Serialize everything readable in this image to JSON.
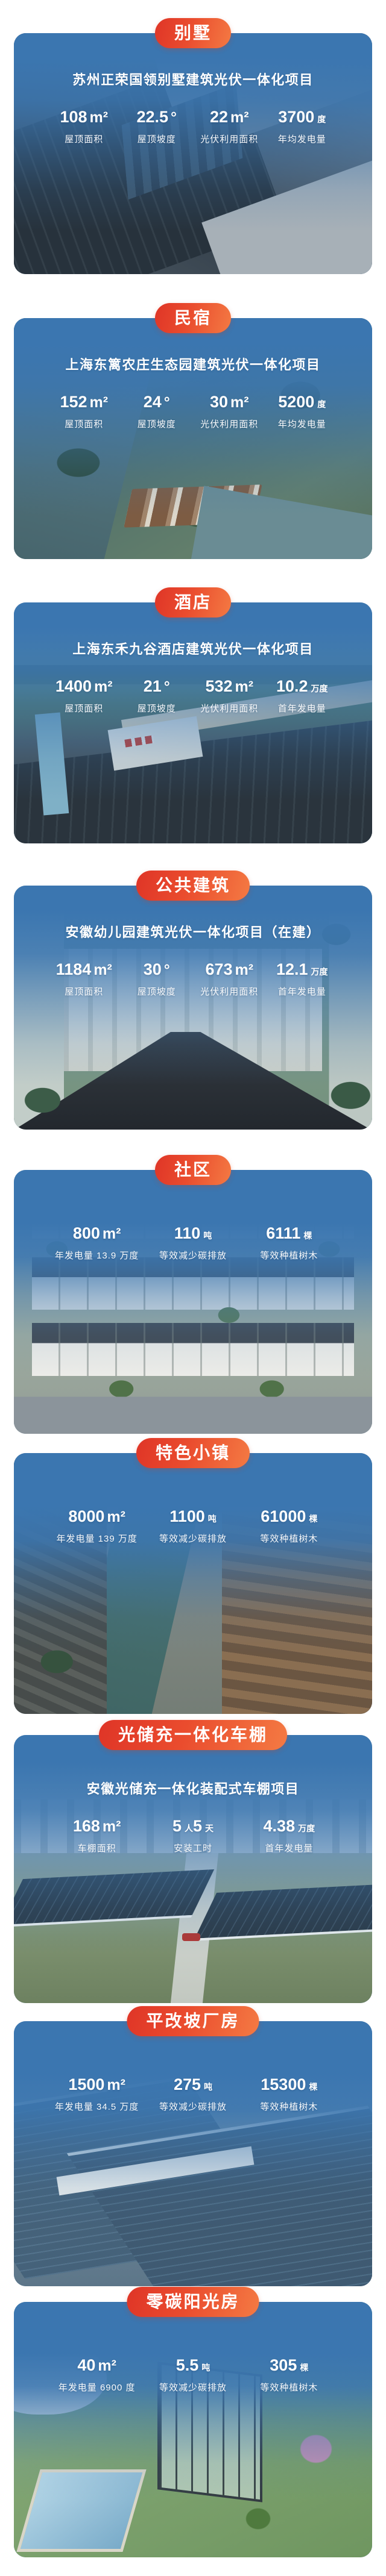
{
  "colors": {
    "badge_red_start": "#df3527",
    "badge_red_end": "#f47a43",
    "card_blue": "#3b76b0",
    "text_white": "#ffffff"
  },
  "sections": [
    {
      "badge": "别墅",
      "title": "苏州正荣国领别墅建筑光伏一体化项目",
      "stats": [
        {
          "value": "108",
          "unit": "m²",
          "label": "屋顶面积"
        },
        {
          "value": "22.5",
          "unit": "°",
          "label": "屋顶坡度"
        },
        {
          "value": "22",
          "unit": "m²",
          "label": "光伏利用面积"
        },
        {
          "value": "3700",
          "unit": "度",
          "label": "年均发电量"
        }
      ]
    },
    {
      "badge": "民宿",
      "title": "上海东篱农庄生态园建筑光伏一体化项目",
      "stats": [
        {
          "value": "152",
          "unit": "m²",
          "label": "屋顶面积"
        },
        {
          "value": "24",
          "unit": "°",
          "label": "屋顶坡度"
        },
        {
          "value": "30",
          "unit": "m²",
          "label": "光伏利用面积"
        },
        {
          "value": "5200",
          "unit": "度",
          "label": "年均发电量"
        }
      ]
    },
    {
      "badge": "酒店",
      "title": "上海东禾九谷酒店建筑光伏一体化项目",
      "stats": [
        {
          "value": "1400",
          "unit": "m²",
          "label": "屋顶面积"
        },
        {
          "value": "21",
          "unit": "°",
          "label": "屋顶坡度"
        },
        {
          "value": "532",
          "unit": "m²",
          "label": "光伏利用面积"
        },
        {
          "value": "10.2",
          "unit": "万度",
          "label": "首年发电量"
        }
      ]
    },
    {
      "badge": "公共建筑",
      "title": "安徽幼儿园建筑光伏一体化项目（在建）",
      "stats": [
        {
          "value": "1184",
          "unit": "m²",
          "label": "屋顶面积"
        },
        {
          "value": "30",
          "unit": "°",
          "label": "屋顶坡度"
        },
        {
          "value": "673",
          "unit": "m²",
          "label": "光伏利用面积"
        },
        {
          "value": "12.1",
          "unit": "万度",
          "label": "首年发电量"
        }
      ]
    },
    {
      "badge": "社区",
      "stats": [
        {
          "value": "800",
          "unit": "m²",
          "label": "年发电量 13.9 万度"
        },
        {
          "value": "110",
          "unit": "吨",
          "label": "等效减少碳排放"
        },
        {
          "value": "6111",
          "unit": "棵",
          "label": "等效种植树木"
        }
      ]
    },
    {
      "badge": "特色小镇",
      "stats": [
        {
          "value": "8000",
          "unit": "m²",
          "label": "年发电量 139 万度"
        },
        {
          "value": "1100",
          "unit": "吨",
          "label": "等效减少碳排放"
        },
        {
          "value": "61000",
          "unit": "棵",
          "label": "等效种植树木"
        }
      ]
    },
    {
      "badge": "光储充一体化车棚",
      "title": "安徽光储充一体化装配式车棚项目",
      "stats": [
        {
          "value": "168",
          "unit": "m²",
          "label": "车棚面积"
        },
        {
          "value": "5",
          "unit": "人",
          "value2": "5",
          "unit2": "天",
          "label": "安装工时"
        },
        {
          "value": "4.38",
          "unit": "万度",
          "label": "首年发电量"
        }
      ]
    },
    {
      "badge": "平改坡厂房",
      "stats": [
        {
          "value": "1500",
          "unit": "m²",
          "label": "年发电量 34.5 万度"
        },
        {
          "value": "275",
          "unit": "吨",
          "label": "等效减少碳排放"
        },
        {
          "value": "15300",
          "unit": "棵",
          "label": "等效种植树木"
        }
      ]
    },
    {
      "badge": "零碳阳光房",
      "stats": [
        {
          "value": "40",
          "unit": "m²",
          "label": "年发电量 6900 度"
        },
        {
          "value": "5.5",
          "unit": "吨",
          "label": "等效减少碳排放"
        },
        {
          "value": "305",
          "unit": "棵",
          "label": "等效种植树木"
        }
      ]
    }
  ]
}
